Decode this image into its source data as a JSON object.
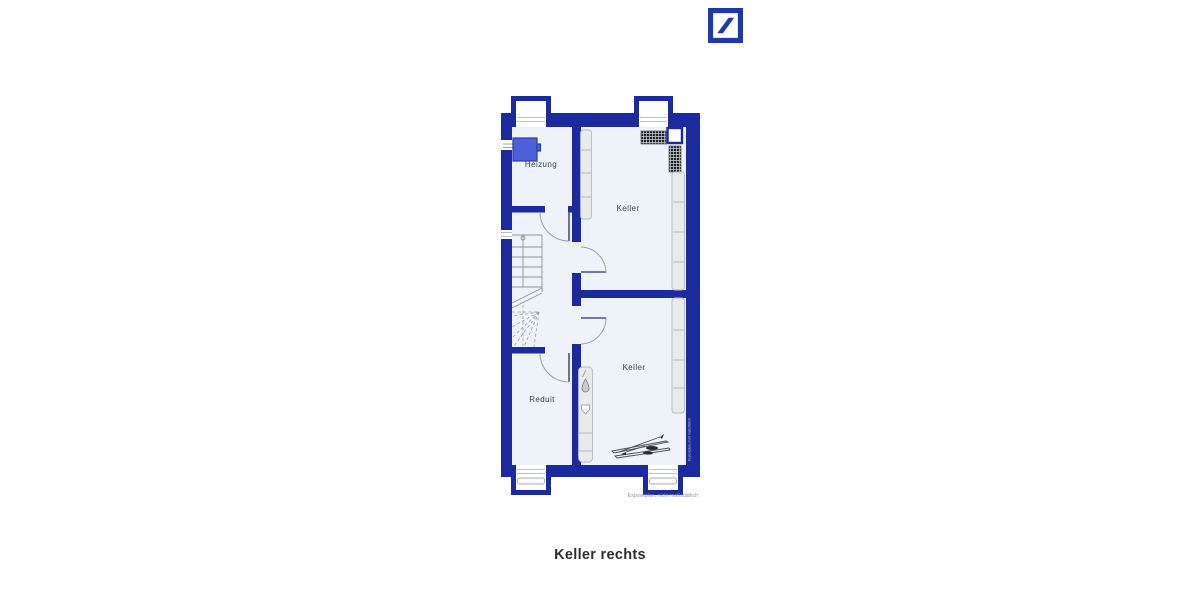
{
  "brand": {
    "logo_icon": "deutsche-bank-slash-logo"
  },
  "plan": {
    "rooms": [
      {
        "id": "heizung",
        "label": "Heizung"
      },
      {
        "id": "keller-top",
        "label": "Keller"
      },
      {
        "id": "keller-bottom",
        "label": "Keller"
      },
      {
        "id": "reduit",
        "label": "Reduit"
      }
    ],
    "disclaimer": "Exposéplan, nicht maßstäblich",
    "watermark_vertical": "Exposéplan, nicht maßstäblich"
  },
  "caption": {
    "title": "Keller rechts"
  },
  "colors": {
    "wall_blue": "#1b2b9d",
    "logo_blue": "#1e3aa8",
    "heater_blue": "#4c61d6",
    "floor": "#eef2f9"
  }
}
